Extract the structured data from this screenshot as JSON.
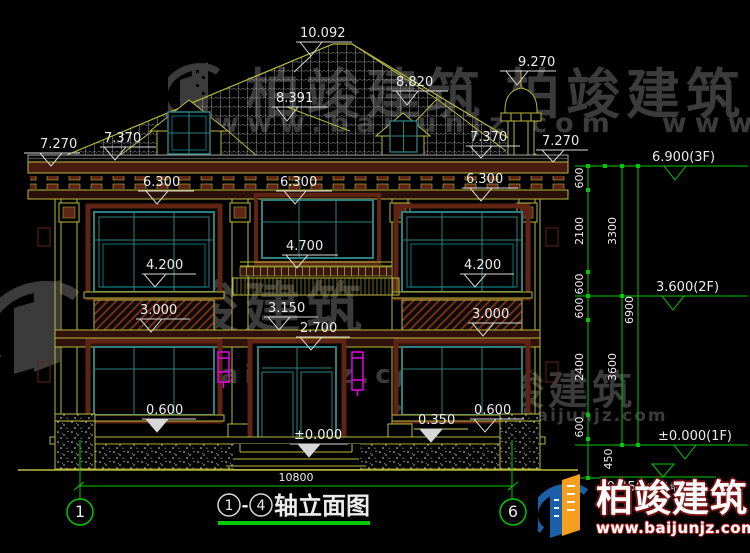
{
  "watermark": {
    "name": "柏竣建筑",
    "url": "www.baijunjz.com"
  },
  "brand": {
    "name": "柏竣建筑",
    "url": "www.baijunjz.com"
  },
  "title": {
    "axis_a": "1",
    "dash": "-",
    "axis_b": "4",
    "label": "轴立面图"
  },
  "axis_bubbles": {
    "left": "1",
    "right": "6"
  },
  "overall_dim": "10800",
  "marks": {
    "m10092": "10.092",
    "m9270": "9.270",
    "m8820": "8.820",
    "m8391": "8.391",
    "m7370L": "7.370",
    "m7270L": "7.270",
    "m7370R": "7.370",
    "m7270R": "7.270",
    "m6300a": "6.300",
    "m6300b": "6.300",
    "m6300c": "6.300",
    "m4200L": "4.200",
    "m4700": "4.700",
    "m4200R": "4.200",
    "m3150": "3.150",
    "m3000L": "3.000",
    "m3000R": "3.000",
    "m2700": "2.700",
    "m0600L": "0.600",
    "m0350": "0.350",
    "m0600R": "0.600",
    "m0000": "±0.000"
  },
  "levels": {
    "f3": "6.900(3F)",
    "f2": "3.600(2F)",
    "f1": "±0.000(1F)",
    "ground_value": "-0.450",
    "ground_paren": "(室外地坪)"
  },
  "vdims": {
    "d600a": "600",
    "d2100": "2100",
    "d600b": "600",
    "d600c": "600",
    "d2400": "2400",
    "d600d": "600",
    "d450": "450",
    "d3300": "3300",
    "d3600": "3600",
    "d6900": "6900"
  },
  "colors": {
    "line_yellow": "#b9b93e",
    "line_maroon": "#5f2414",
    "line_teal": "#2e8080",
    "line_cyan": "#00a8b8",
    "dim_green": "#00c800",
    "text_white": "#ececec",
    "lamp_magenta": "#e800e8",
    "watermark_gray": "#3b3b3b",
    "logo_blue": "#1a5fa8",
    "logo_orange": "#f59f1f",
    "logo_red": "#c02020"
  }
}
